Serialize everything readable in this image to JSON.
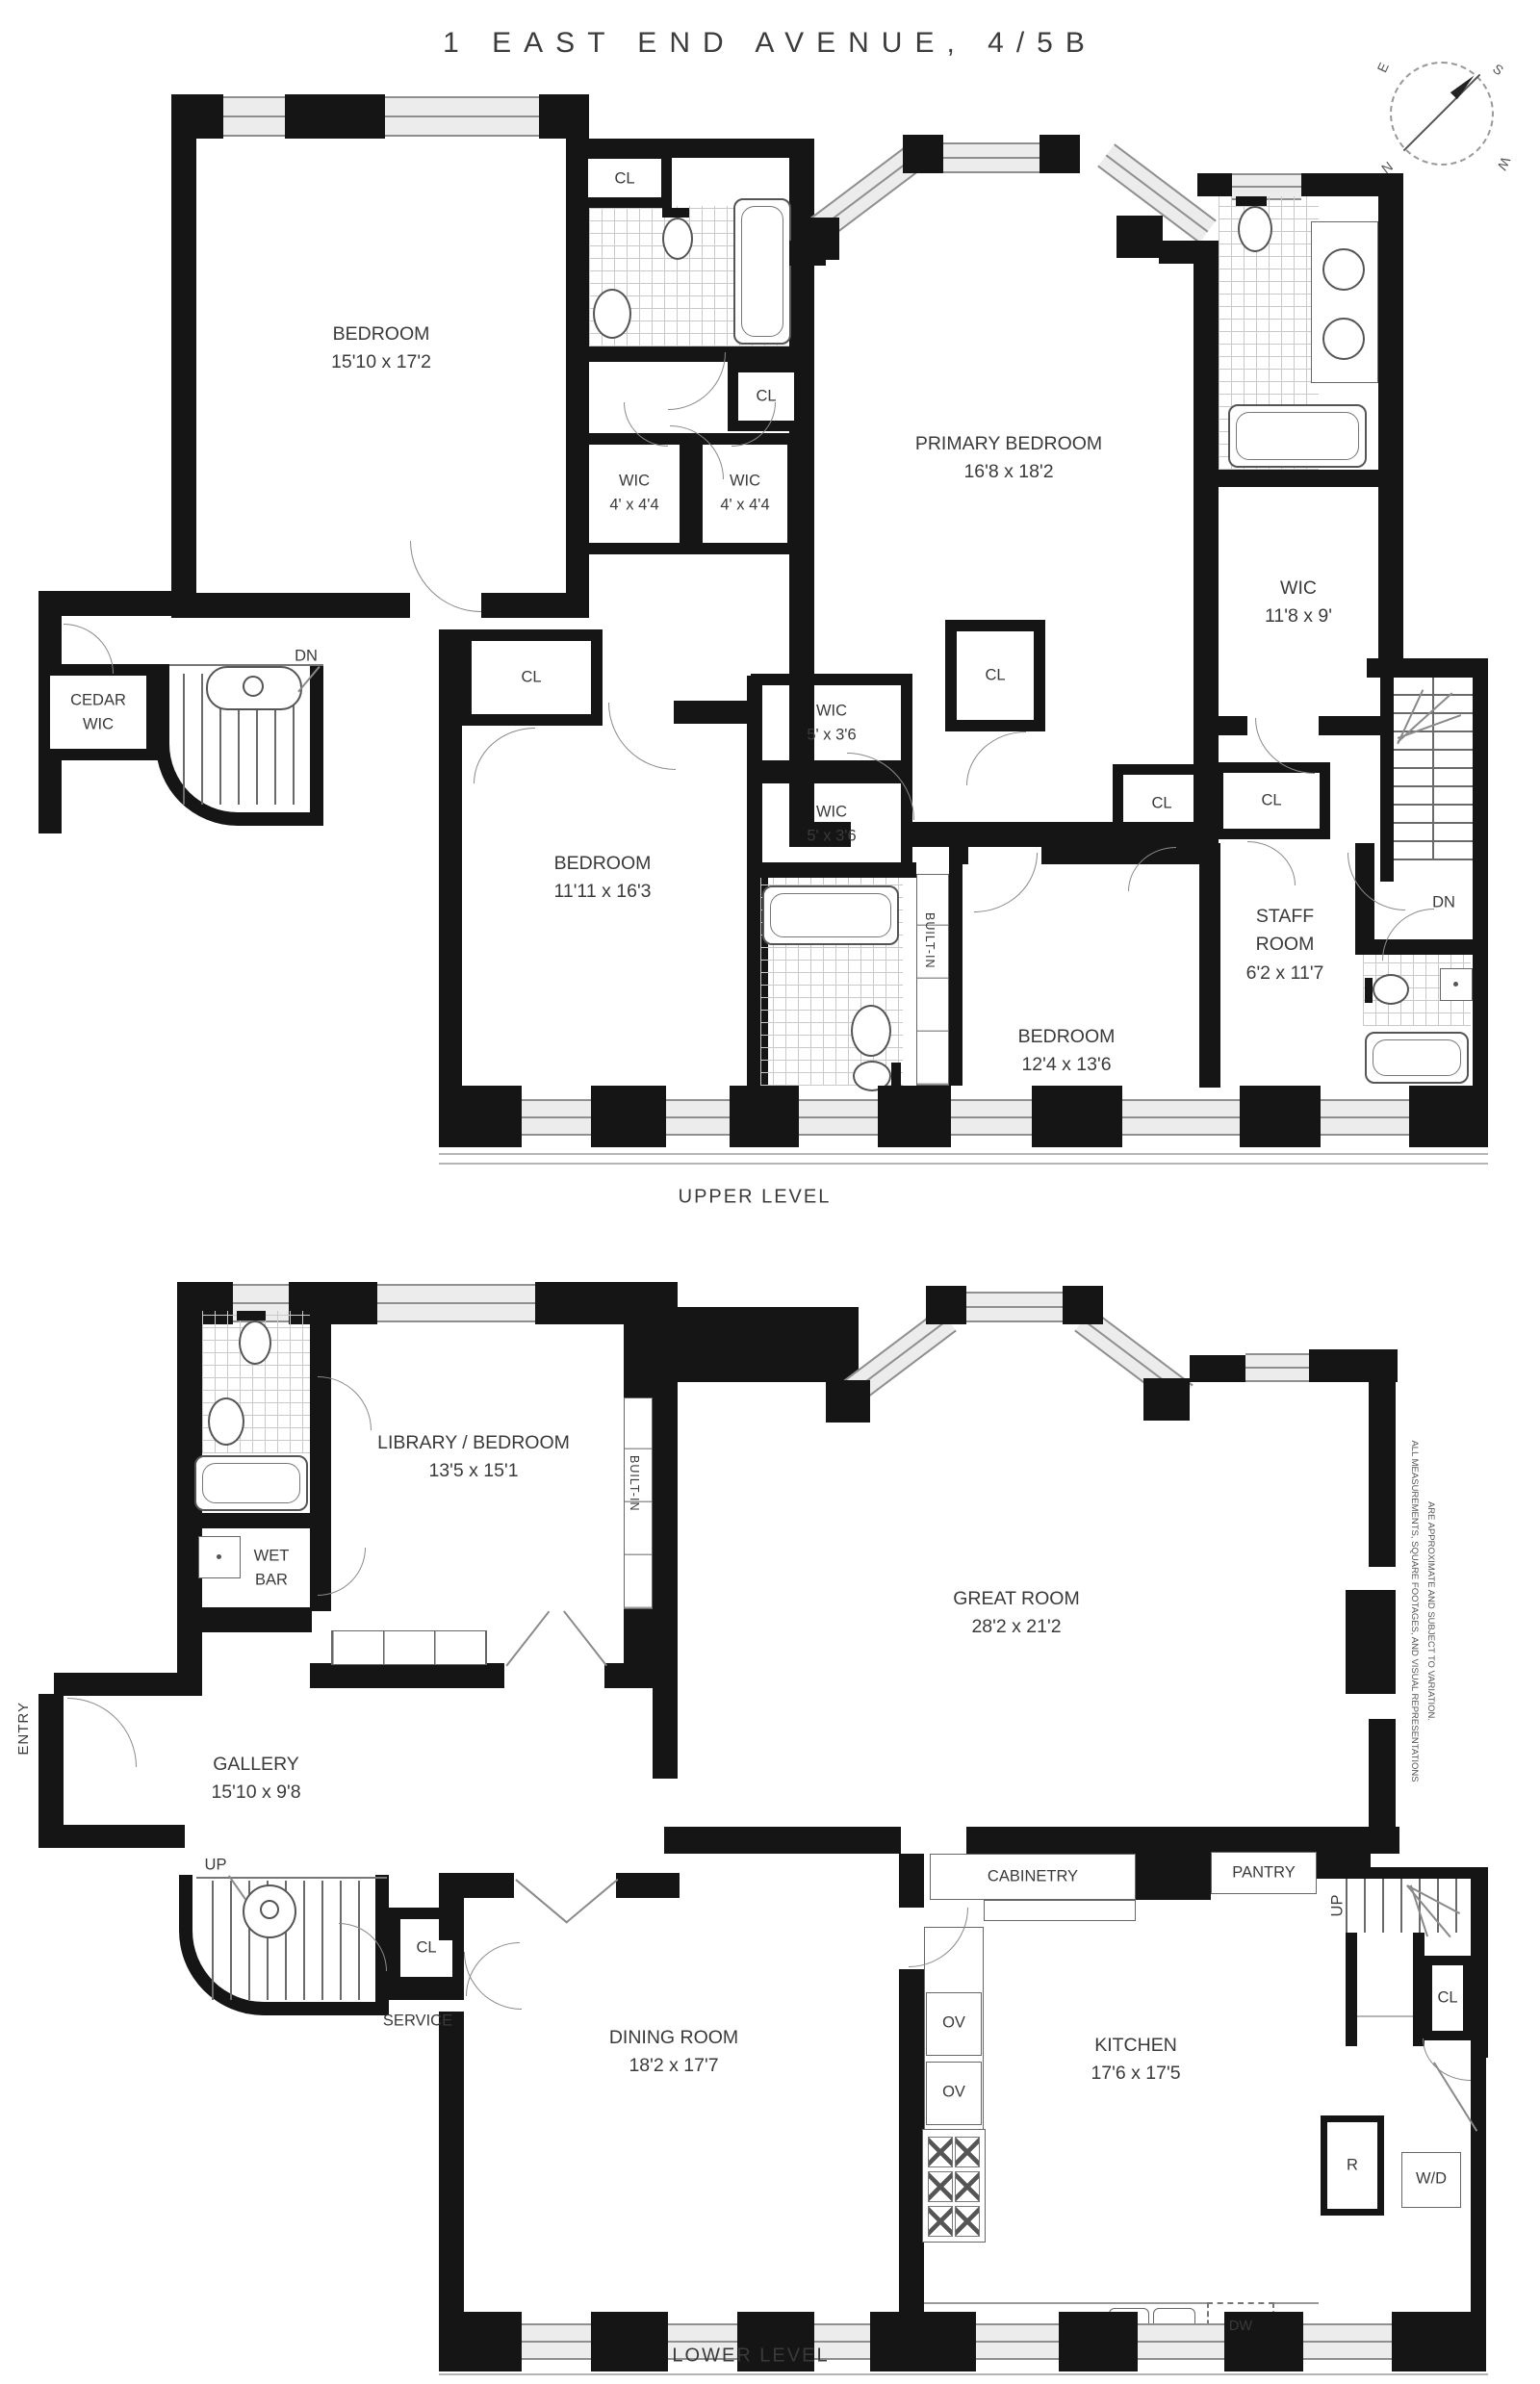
{
  "title": "1 EAST END AVENUE, 4/5B",
  "levels": {
    "upper": "UPPER LEVEL",
    "lower": "LOWER LEVEL"
  },
  "compass": {
    "n": "N",
    "e": "E",
    "s": "S",
    "w": "W"
  },
  "disclaimer": {
    "line1": "ALL MEASUREMENTS, SQUARE FOOTAGES, AND VISUAL REPRESENTATIONS",
    "line2": "ARE APPROXIMATE AND SUBJECT TO VARIATION."
  },
  "abbr": {
    "cl": "CL",
    "dn": "DN",
    "up": "UP",
    "service": "SERVICE",
    "entry": "ENTRY",
    "built_in": "BUILT-IN",
    "cabinetry": "CABINETRY",
    "pantry": "PANTRY",
    "ov": "OV",
    "r": "R",
    "wd": "W/D",
    "dw": "DW"
  },
  "upper": {
    "bedroom1": {
      "name": "BEDROOM",
      "dims": "15'10 x 17'2"
    },
    "primary": {
      "name": "PRIMARY BEDROOM",
      "dims": "16'8 x 18'2"
    },
    "wic44a": {
      "name": "WIC",
      "dims": "4' x 4'4"
    },
    "wic44b": {
      "name": "WIC",
      "dims": "4' x 4'4"
    },
    "wic118": {
      "name": "WIC",
      "dims": "11'8 x 9'"
    },
    "cedar": {
      "l1": "CEDAR",
      "l2": "WIC"
    },
    "bedroom2": {
      "name": "BEDROOM",
      "dims": "11'11 x 16'3"
    },
    "wic5a": {
      "name": "WIC",
      "dims": "5' x 3'6"
    },
    "wic5b": {
      "name": "WIC",
      "dims": "5' x 3'6"
    },
    "bedroom3": {
      "name": "BEDROOM",
      "dims": "12'4 x 13'6"
    },
    "staff": {
      "l1": "STAFF",
      "l2": "ROOM",
      "dims": "6'2 x 11'7"
    }
  },
  "lower": {
    "library": {
      "name": "LIBRARY / BEDROOM",
      "dims": "13'5 x 15'1"
    },
    "great": {
      "name": "GREAT ROOM",
      "dims": "28'2 x 21'2"
    },
    "gallery": {
      "name": "GALLERY",
      "dims": "15'10 x 9'8"
    },
    "dining": {
      "name": "DINING ROOM",
      "dims": "18'2 x 17'7"
    },
    "kitchen": {
      "name": "KITCHEN",
      "dims": "17'6 x 17'5"
    },
    "wetbar": {
      "l1": "WET",
      "l2": "BAR"
    }
  }
}
